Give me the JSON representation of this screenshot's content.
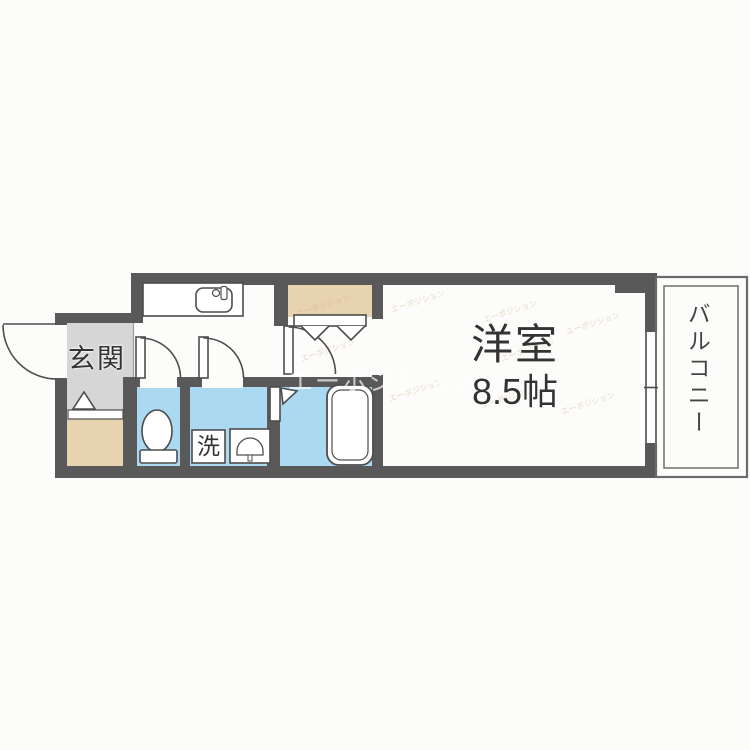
{
  "rooms": {
    "entrance": {
      "label": "玄関"
    },
    "western_room": {
      "label": "洋室",
      "size": "8.5帖"
    },
    "balcony": {
      "label": "バルコニー"
    },
    "laundry_pan": {
      "label": "洗"
    }
  },
  "watermark": {
    "text": "エーポジション"
  },
  "fixtures": {
    "kitchen_sink": "kitchen-sink-icon",
    "toilet": "toilet-icon",
    "washbasin": "washbasin-icon",
    "bathtub": "bathtub-icon",
    "closet_bifold_door": "bifold-door-icon",
    "bath_folding_door": "folding-door-icon",
    "entrance_door": "entrance-door-arc",
    "interior_doors": "door-swing-arc",
    "window": "sliding-window-icon",
    "step_marker": "entrance-step-triangle"
  },
  "colors": {
    "wall": "#595959",
    "wet_area_floor": "#aad9f1",
    "entrance_floor": "#d6d6d6",
    "storage_floor": "#e8d3b0",
    "outline": "#4d4d4d",
    "label_text": "#333333",
    "watermark_tile": "#c4945e"
  }
}
